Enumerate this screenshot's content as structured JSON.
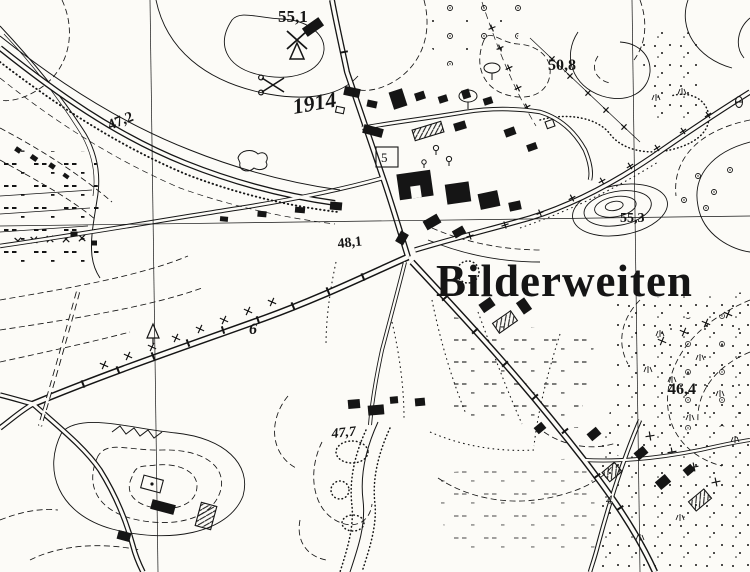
{
  "map": {
    "ink_color": "#151515",
    "paper_color": "#fcfbf7",
    "town_label": "Bilderweiten",
    "battle": {
      "year_label": "1914",
      "symbol": "crossed-swords-icon"
    },
    "windmill": {
      "symbol": "windmill-icon"
    },
    "spot_heights": [
      {
        "text": "55,1"
      },
      {
        "text": "47,2"
      },
      {
        "text": "50,8"
      },
      {
        "text": "55,3"
      },
      {
        "text": "48,1"
      },
      {
        "text": "46,4"
      },
      {
        "text": "47,7"
      }
    ],
    "parcel_numbers": [
      {
        "text": "5"
      },
      {
        "text": "6"
      },
      {
        "text": "4"
      }
    ],
    "icons": {
      "windmill": "windmill-icon",
      "battle_site": "crossed-swords-icon",
      "survey_signal": "survey-signal-icon",
      "tree": "tree-icon",
      "depression": "depression-icon"
    }
  }
}
